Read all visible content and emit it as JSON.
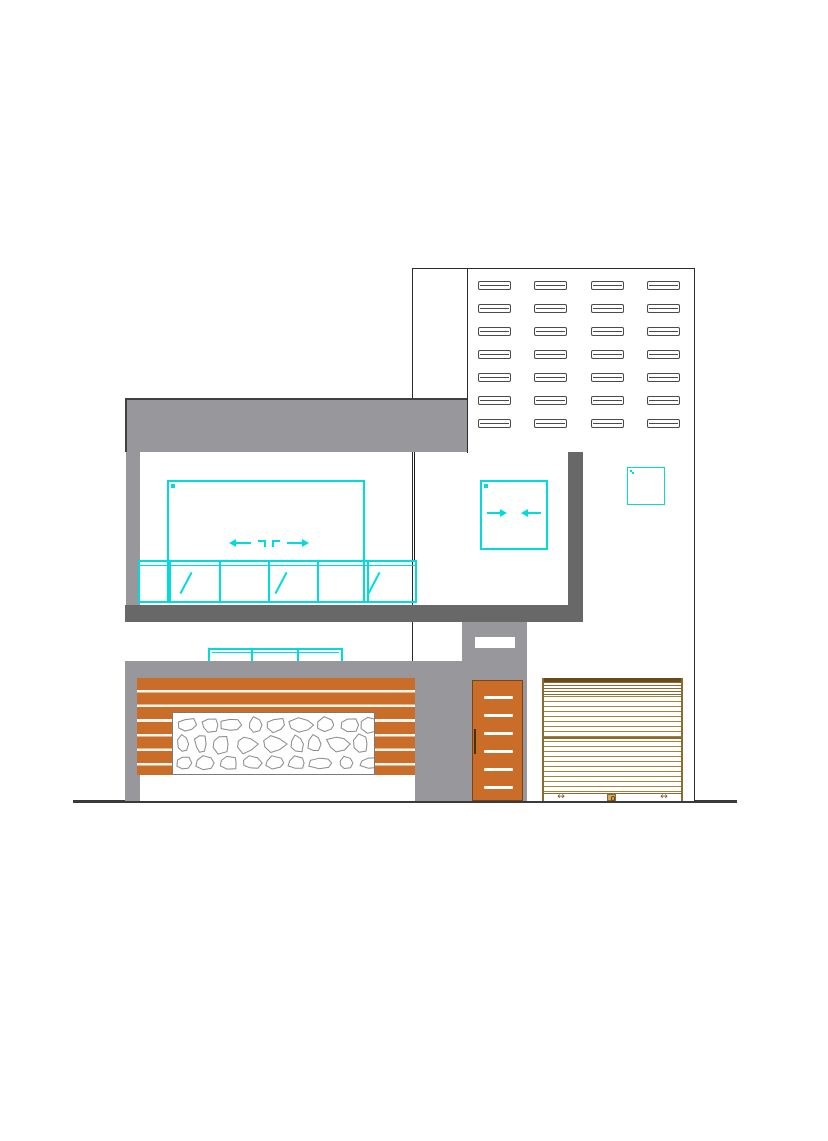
{
  "drawing": {
    "type": "architectural-elevation",
    "title": "Residential House Front Elevation",
    "notes": "CAD elevation drawing; no text labels visible in the drawing"
  },
  "colors": {
    "wall_gray": "#97979c",
    "slab_gray": "#686868",
    "outline_dark": "#2b2b2b",
    "window_cyan": "#00dcdc",
    "wood_orange": "#c96d28",
    "shutter_tan": "#a6823f",
    "shutter_dark_brown": "#6b4a1a",
    "stone_outline": "#8a8a8a",
    "door_handle_brown": "#4a2f08",
    "ground_line": "#3a3a3a"
  },
  "elements": {
    "vent_grid": {
      "rows": 7,
      "cols": 4
    },
    "louver_window": {
      "leaves": 2,
      "slats_per_leaf": 5
    },
    "sliding_window_large": {
      "panels": 4,
      "slide_hint": "arrows-outward"
    },
    "sliding_window_small": {
      "panels": 2,
      "slide_hint": "arrows-inward"
    },
    "balcony_glazing": {
      "divider_offsets": [
        29,
        79,
        128,
        177,
        227
      ],
      "slash_offsets": [
        45,
        140,
        233
      ]
    },
    "hidden_ground_window": {
      "cells": 3
    },
    "gate": {
      "slats": 7
    },
    "door": {
      "stripes": 6,
      "stripe_offsets": [
        15,
        33,
        51,
        69,
        87,
        105
      ]
    },
    "shutter": {
      "handles": 2,
      "lock": 1,
      "handle_glyph": "↔"
    }
  }
}
